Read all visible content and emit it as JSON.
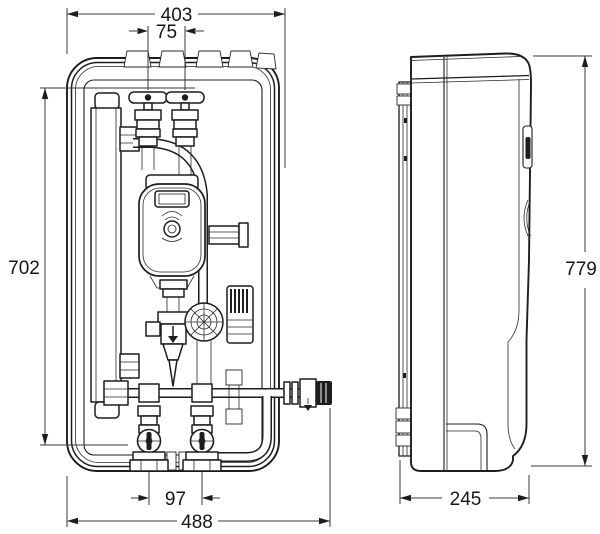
{
  "drawing": {
    "kind": "technical dimension drawing, front and side view of wall-mounted hydraulic unit",
    "colors": {
      "background": "#ffffff",
      "line": "#1d1d1d",
      "dimension_line": "#3a3a3a"
    }
  },
  "dimensions": {
    "front": {
      "overall_width": "403",
      "top_connection_spacing": "75",
      "mounting_height": "702",
      "bottom_connection_spacing": "97",
      "overall_width_with_side_valve": "488"
    },
    "side": {
      "overall_height": "779",
      "overall_depth": "245"
    }
  }
}
